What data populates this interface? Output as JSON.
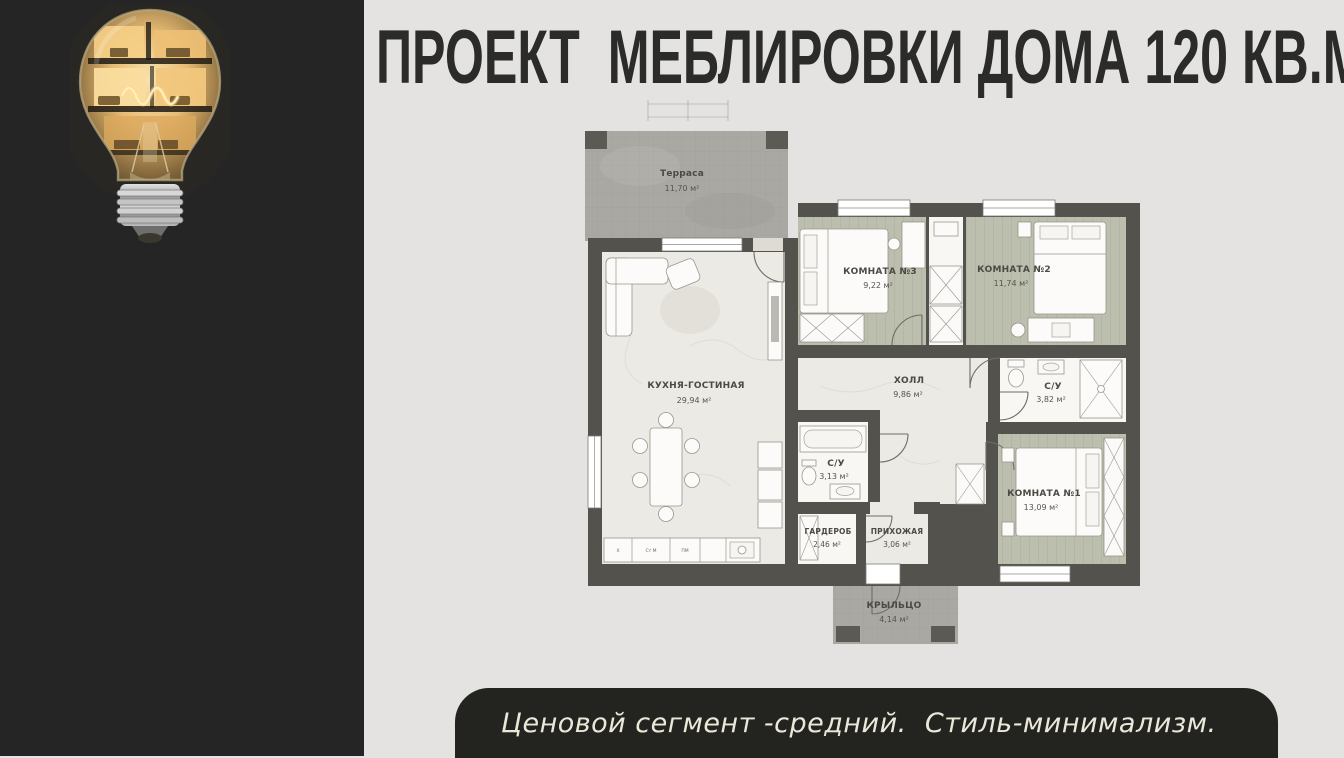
{
  "header": {
    "title": "ПРОЕКТ  МЕБЛИРОВКИ ДОМА 120 КВ.М"
  },
  "footer": {
    "text": "Ценовой сегмент -средний.  Стиль-минимализм."
  },
  "plan": {
    "rooms": [
      {
        "name": "Терраса",
        "area": "11,70 м²"
      },
      {
        "name": "КОМНАТА №3",
        "area": "9,22 м²"
      },
      {
        "name": "КОМНАТА №2",
        "area": "11,74 м²"
      },
      {
        "name": "КУХНЯ-ГОСТИНАЯ",
        "area": "29,94 м²"
      },
      {
        "name": "ХОЛЛ",
        "area": "9,86 м²"
      },
      {
        "name": "С/У",
        "area": "3,82 м²"
      },
      {
        "name": "С/У",
        "area": "3,13 м²"
      },
      {
        "name": "КОМНАТА №1",
        "area": "13,09 м²"
      },
      {
        "name": "ГАРДЕРОБ",
        "area": "2,46 м²"
      },
      {
        "name": "ПРИХОЖАЯ",
        "area": "3,06 м²"
      },
      {
        "name": "КРЫЛЬЦО",
        "area": "4,14 м²"
      }
    ],
    "kitchen_units": [
      "X",
      "Ст М",
      "ПМ"
    ]
  },
  "colors": {
    "background": "#e4e3e1",
    "left_panel": "#252525",
    "footer_bar": "#23241f",
    "footer_text": "#ebe8da",
    "title_text": "#2b2b29",
    "plan_wall": "#54524c",
    "wood_floor": "#bcbfae",
    "tile_floor": "#a9a8a3",
    "marble_floor": "#eceae5"
  }
}
